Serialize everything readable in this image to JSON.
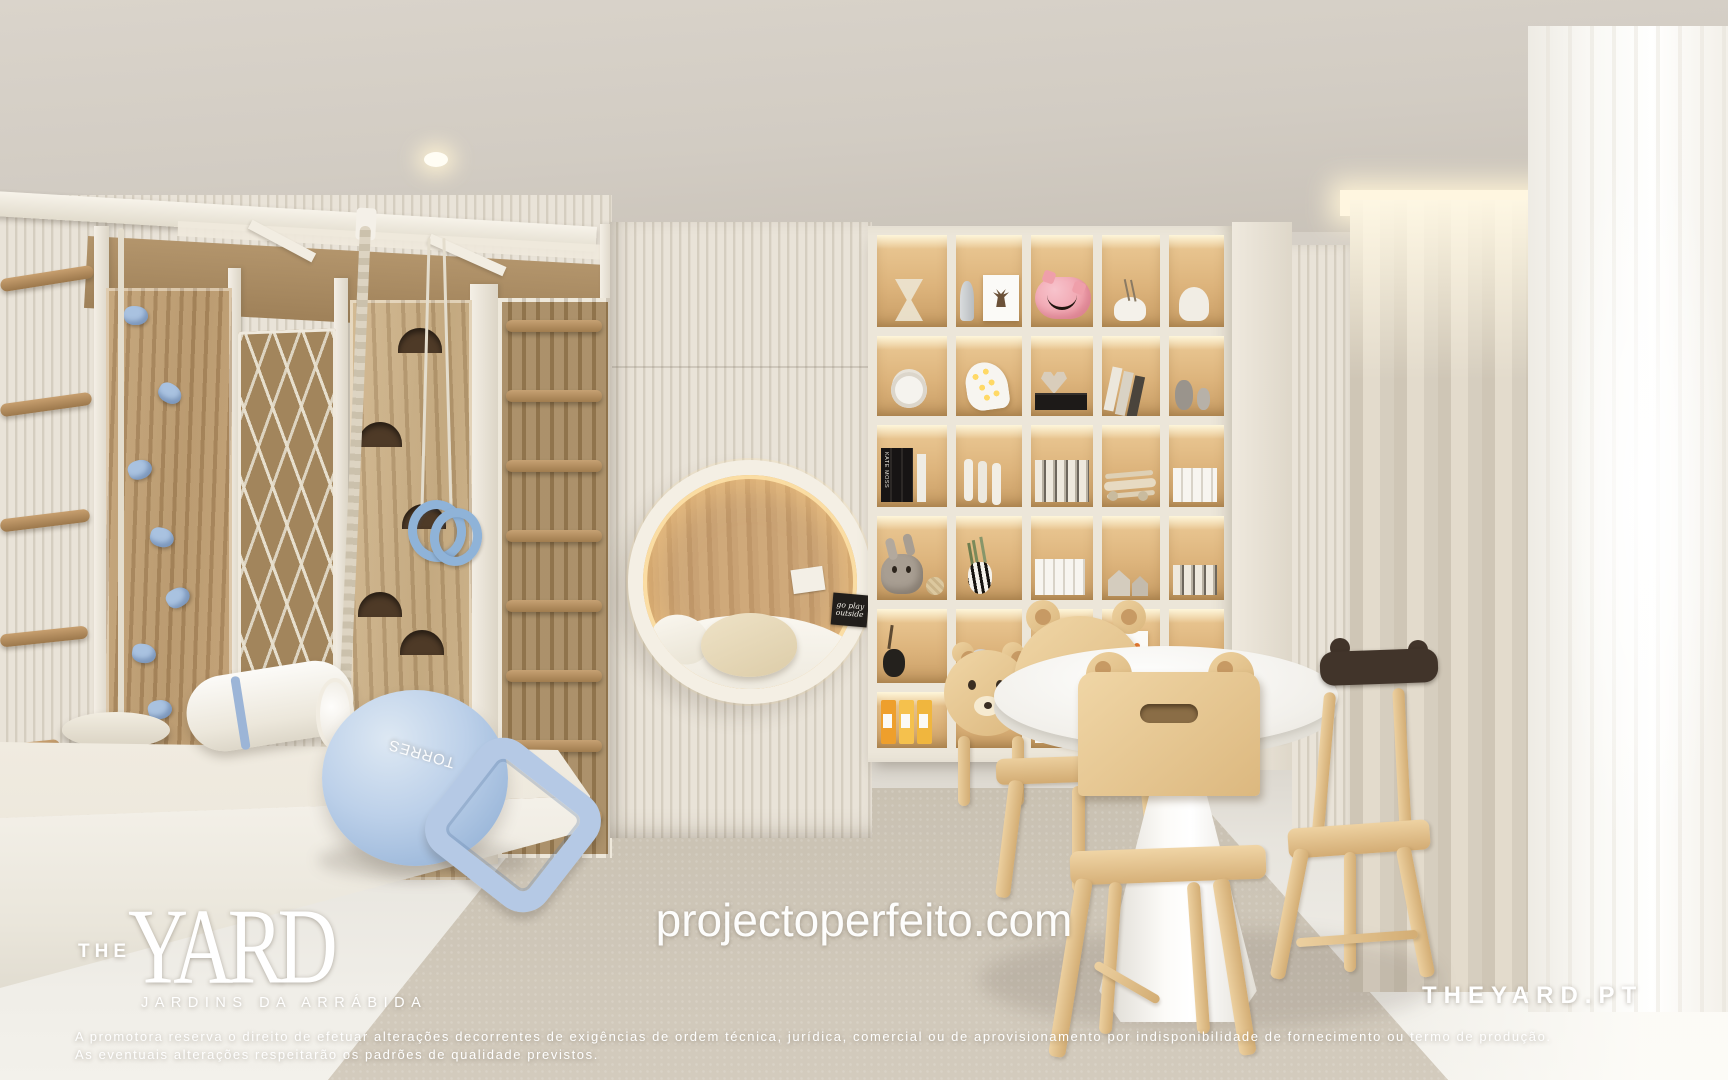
{
  "branding": {
    "logo_the": "THE",
    "logo_yard": "YARD",
    "logo_subtitle": "JARDINS DA ARRÁBIDA",
    "watermark_url": "projectoperfeito.com",
    "site_badge": "THEYARD.PT"
  },
  "disclaimer": {
    "line1": "A promotora reserva o direito de efetuar alterações decorrentes de exigências de ordem técnica, jurídica, comercial ou de aprovisionamento por indisponibilidade de fornecimento ou termo de produção.",
    "line2": "As eventuais alterações respeitarão os padrões de qualidade previstos."
  },
  "scene": {
    "ball_brand_text": "TORRES",
    "nook_sign_text": "go play outside",
    "book_spine_text": "KATE MOSS",
    "colors": {
      "slat_wall": "#e6e0d4",
      "wood_panel": "#b5946a",
      "climbing_holds_blue": "#a9c2e0",
      "ball_blue": "#b3c9e6",
      "shelf_glow": "#ffe9c0",
      "curtain_beige": "#d8d0c2",
      "pig_pink": "#f2a9b4",
      "binder_yellow": "#f0b63e",
      "rug_greige": "#cdc5b7"
    }
  }
}
